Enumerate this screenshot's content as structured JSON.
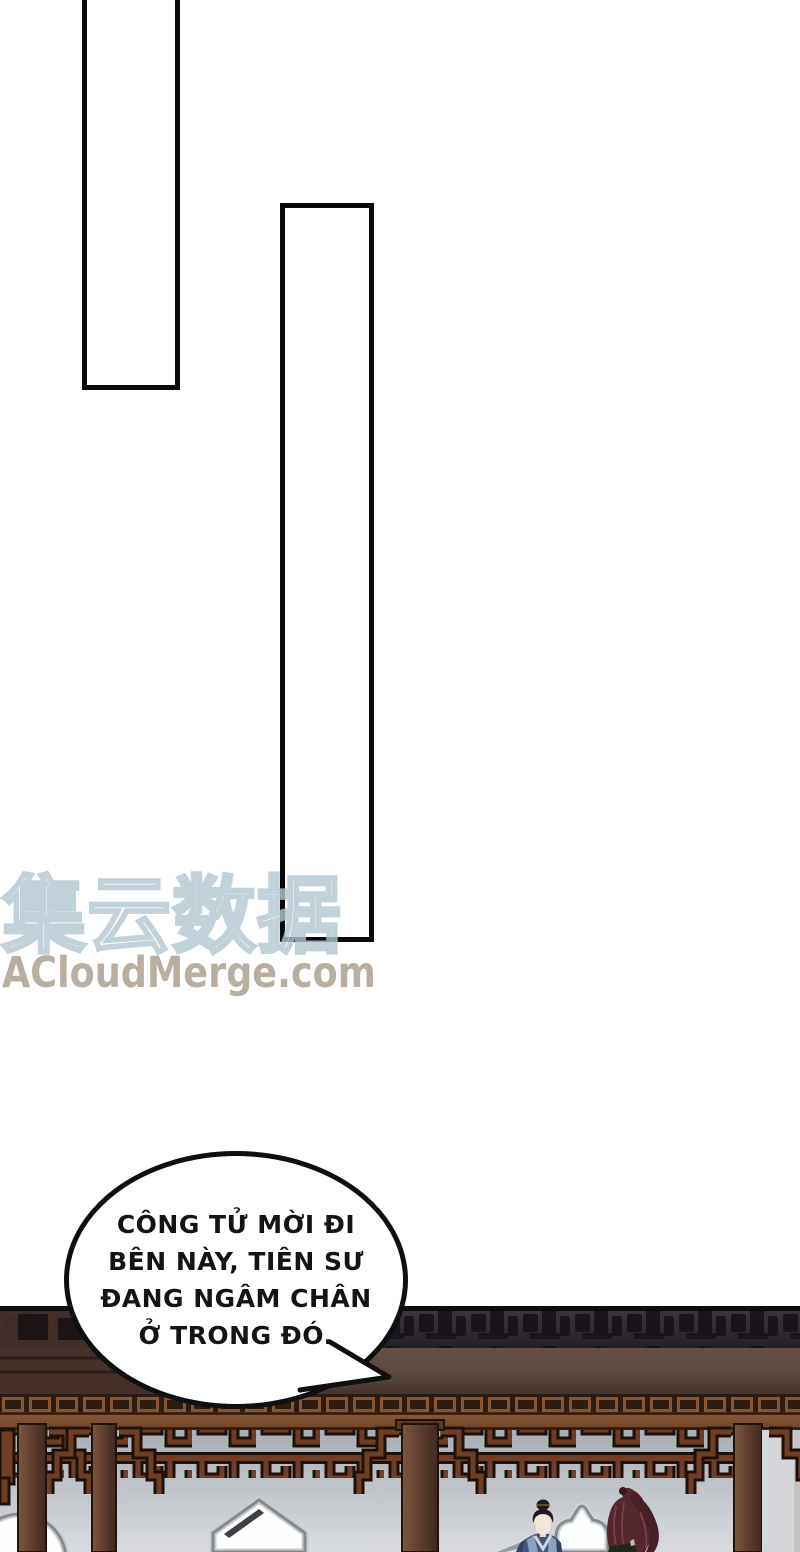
{
  "watermark": {
    "brand_cjk": "集云数据",
    "brand_site": "ACloudMerge.com",
    "outline_color": "#b3c7d2",
    "site_color": "#b4a897"
  },
  "speech_bubble": {
    "lines": [
      "CÔNG TỬ MỜI ĐI",
      "BÊN NÀY, TIÊN SƯ",
      "ĐANG NGÂM CHÂN",
      "Ở TRONG ĐÓ."
    ],
    "text_color": "#141414",
    "border_color": "#0f0f0f",
    "fill_color": "#ffffff"
  },
  "panels": {
    "count": 2,
    "border_color": "#0a0a0a",
    "fill_color": "#ffffff"
  },
  "scene_colors": {
    "roof_silhouette": "#16121a",
    "roof_band": "#352e38",
    "main_beam": "#5e4a40",
    "left_eave_dark": "#442e27",
    "lattice_frieze_bg": "#2b1b12",
    "lattice_frieze_line": "#8a5532",
    "upper_beam": "#7d5134",
    "fretwork_brown": "#6e3f24",
    "fretwork_outline": "#20100a",
    "column_brown": "#5d3c2e",
    "wall_top": "#a9aeb6",
    "wall_bottom": "#dadce0",
    "window_fill": "#fdfefe",
    "window_border": "#85898e",
    "robe_blue": "#44567e",
    "robe_collar": "#cdd5e0",
    "face_skin": "#f4e6d8",
    "hair_black": "#231a1d",
    "hair_red": "#54262d",
    "robe_dark_green": "#212619",
    "railing_slate": "#8f9dab"
  }
}
